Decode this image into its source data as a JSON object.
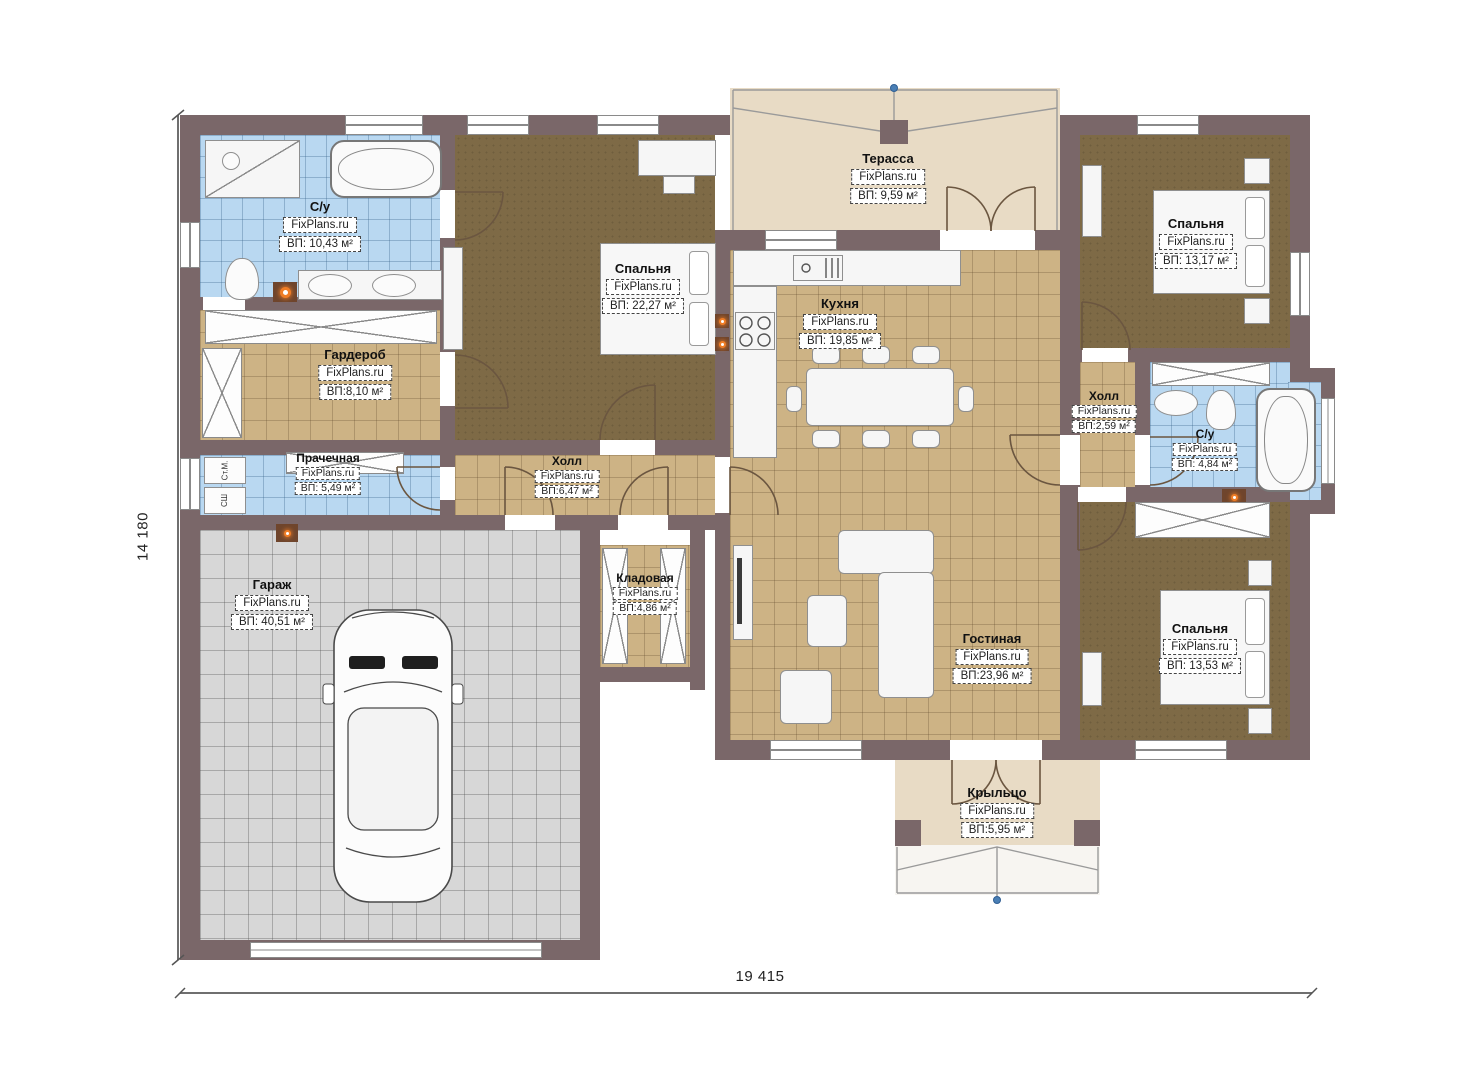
{
  "watermark": "FixPlans.ru",
  "dimensions": {
    "height_label": "14 180",
    "width_label": "19 415"
  },
  "rooms": {
    "su1": {
      "name": "С/у",
      "watermark": "FixPlans.ru",
      "area": "ВП: 10,43 м²"
    },
    "garderob": {
      "name": "Гардероб",
      "watermark": "FixPlans.ru",
      "area": "ВП:8,10 м²"
    },
    "spalnya1": {
      "name": "Спальня",
      "watermark": "FixPlans.ru",
      "area": "ВП: 22,27 м²"
    },
    "terassa": {
      "name": "Терасса",
      "watermark": "FixPlans.ru",
      "area": "ВП: 9,59 м²"
    },
    "kuhnya": {
      "name": "Кухня",
      "watermark": "FixPlans.ru",
      "area": "ВП: 19,85 м²"
    },
    "spalnya2": {
      "name": "Спальня",
      "watermark": "FixPlans.ru",
      "area": "ВП: 13,17 м²"
    },
    "holl2": {
      "name": "Холл",
      "watermark": "FixPlans.ru",
      "area": "ВП:2,59 м²"
    },
    "su2": {
      "name": "С/у",
      "watermark": "FixPlans.ru",
      "area": "ВП: 4,84 м²"
    },
    "prachechnaya": {
      "name": "Прачечная",
      "watermark": "FixPlans.ru",
      "area": "ВП: 5,49 м²"
    },
    "holl1": {
      "name": "Холл",
      "watermark": "FixPlans.ru",
      "area": "ВП:6,47 м²"
    },
    "garazh": {
      "name": "Гараж",
      "watermark": "FixPlans.ru",
      "area": "ВП: 40,51 м²"
    },
    "kladovaya": {
      "name": "Кладовая",
      "watermark": "FixPlans.ru",
      "area": "ВП:4,86 м²"
    },
    "gostinaya": {
      "name": "Гостиная",
      "watermark": "FixPlans.ru",
      "area": "ВП:23,96 м²"
    },
    "spalnya3": {
      "name": "Спальня",
      "watermark": "FixPlans.ru",
      "area": "ВП: 13,53 м²"
    },
    "krylco": {
      "name": "Крыльцо",
      "watermark": "FixPlans.ru",
      "area": "ВП:5,95 м²"
    }
  },
  "appliances": {
    "washer": "Ст.М.",
    "dryer": "СШ"
  },
  "colors": {
    "wall": "#7a6769",
    "bathroom_tile": "#b9d8f1",
    "floor_tile": "#cdb385",
    "carpet": "#7e6a46",
    "garage_floor": "#d7d7d7",
    "deck": "#e8dbc5",
    "accent_orange": "#ef7d26",
    "marker_blue": "#4a7fb5"
  }
}
